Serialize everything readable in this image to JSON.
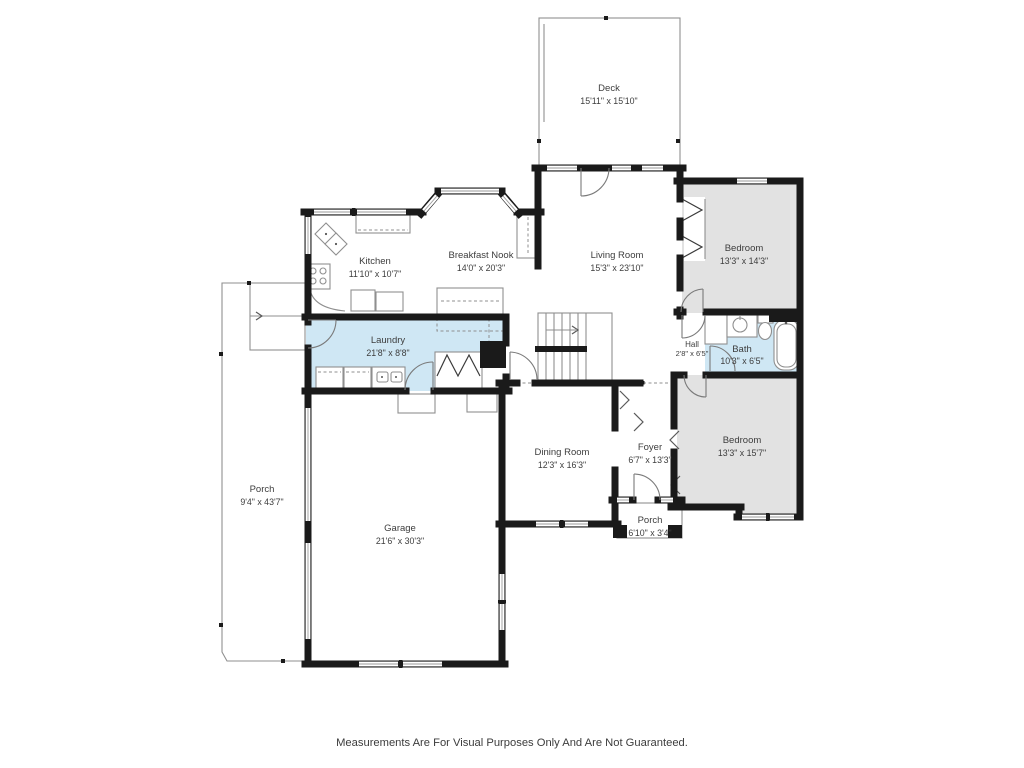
{
  "colors": {
    "wall": "#1a1a1a",
    "bedroom_fill": "#e2e2e2",
    "wet_room_fill": "#cfe7f4",
    "line": "#8f8f8f",
    "text": "#3d3d3d"
  },
  "rooms": [
    {
      "id": "deck",
      "name": "Deck",
      "dims": "15'11\" x 15'10\""
    },
    {
      "id": "kitchen",
      "name": "Kitchen",
      "dims": "11'10\" x 10'7\""
    },
    {
      "id": "breakfast-nook",
      "name": "Breakfast Nook",
      "dims": "14'0\" x 20'3\""
    },
    {
      "id": "living-room",
      "name": "Living Room",
      "dims": "15'3\" x 23'10\""
    },
    {
      "id": "bedroom-upper",
      "name": "Bedroom",
      "dims": "13'3\" x 14'3\""
    },
    {
      "id": "hall",
      "name": "Hall",
      "dims": "2'8\" x 6'5\""
    },
    {
      "id": "bath",
      "name": "Bath",
      "dims": "10'3\" x 6'5\""
    },
    {
      "id": "laundry",
      "name": "Laundry",
      "dims": "21'8\" x 8'8\""
    },
    {
      "id": "bedroom-lower",
      "name": "Bedroom",
      "dims": "13'3\" x 15'7\""
    },
    {
      "id": "dining-room",
      "name": "Dining Room",
      "dims": "12'3\" x 16'3\""
    },
    {
      "id": "foyer",
      "name": "Foyer",
      "dims": "6'7\" x 13'3\""
    },
    {
      "id": "porch-front",
      "name": "Porch",
      "dims": "6'10\" x 3'4\""
    },
    {
      "id": "garage",
      "name": "Garage",
      "dims": "21'6\" x 30'3\""
    },
    {
      "id": "porch-side",
      "name": "Porch",
      "dims": "9'4\" x 43'7\""
    }
  ],
  "footer": {
    "disclaimer": "Measurements Are For Visual Purposes Only And Are Not Guaranteed."
  }
}
